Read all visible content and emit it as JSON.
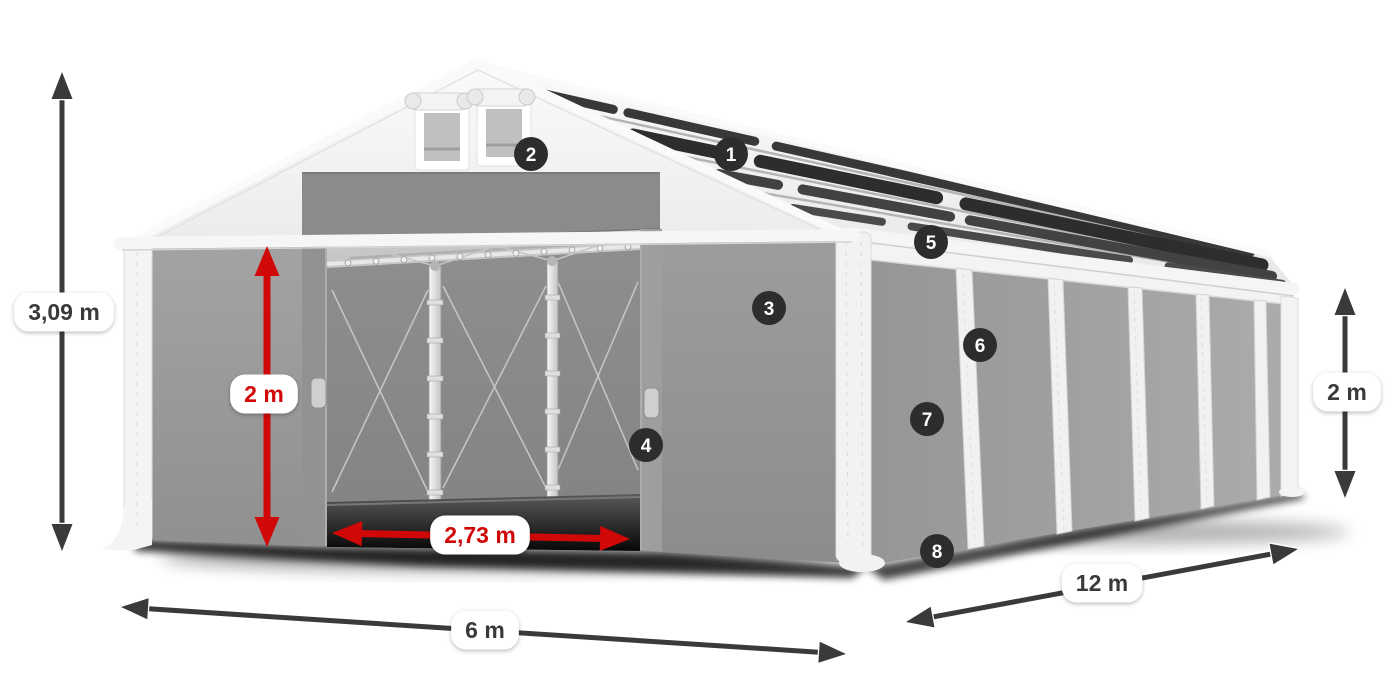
{
  "colors": {
    "accent_red": "#d10808",
    "dim_dark": "#3a3a3a",
    "badge_bg": "#2d2d2d",
    "badge_text": "#ffffff",
    "label_bg": "#ffffff"
  },
  "callouts": [
    {
      "number": "1",
      "x": 731,
      "y": 154
    },
    {
      "number": "2",
      "x": 531,
      "y": 154
    },
    {
      "number": "3",
      "x": 769,
      "y": 308
    },
    {
      "number": "4",
      "x": 646,
      "y": 445
    },
    {
      "number": "5",
      "x": 931,
      "y": 242
    },
    {
      "number": "6",
      "x": 980,
      "y": 345
    },
    {
      "number": "7",
      "x": 927,
      "y": 419
    },
    {
      "number": "8",
      "x": 937,
      "y": 551
    }
  ],
  "dimensions": [
    {
      "id": "total-height",
      "label": "3,09 m",
      "style": "dark",
      "x1": 62,
      "y1": 72,
      "x2": 62,
      "y2": 551,
      "lx": 64,
      "ly": 312
    },
    {
      "id": "door-height",
      "label": "2 m",
      "style": "red",
      "x1": 267,
      "y1": 246,
      "x2": 267,
      "y2": 547,
      "lx": 264,
      "ly": 394
    },
    {
      "id": "door-width",
      "label": "2,73 m",
      "style": "red",
      "x1": 332,
      "y1": 533,
      "x2": 630,
      "y2": 539,
      "lx": 480,
      "ly": 535
    },
    {
      "id": "front-width",
      "label": "6 m",
      "style": "dark",
      "x1": 121,
      "y1": 607,
      "x2": 846,
      "y2": 654,
      "lx": 485,
      "ly": 630
    },
    {
      "id": "side-length",
      "label": "12 m",
      "style": "dark",
      "x1": 906,
      "y1": 622,
      "x2": 1298,
      "y2": 549,
      "lx": 1102,
      "ly": 583
    },
    {
      "id": "side-height",
      "label": "2 m",
      "style": "dark",
      "x1": 1345,
      "y1": 288,
      "x2": 1345,
      "y2": 498,
      "lx": 1347,
      "ly": 392
    }
  ]
}
